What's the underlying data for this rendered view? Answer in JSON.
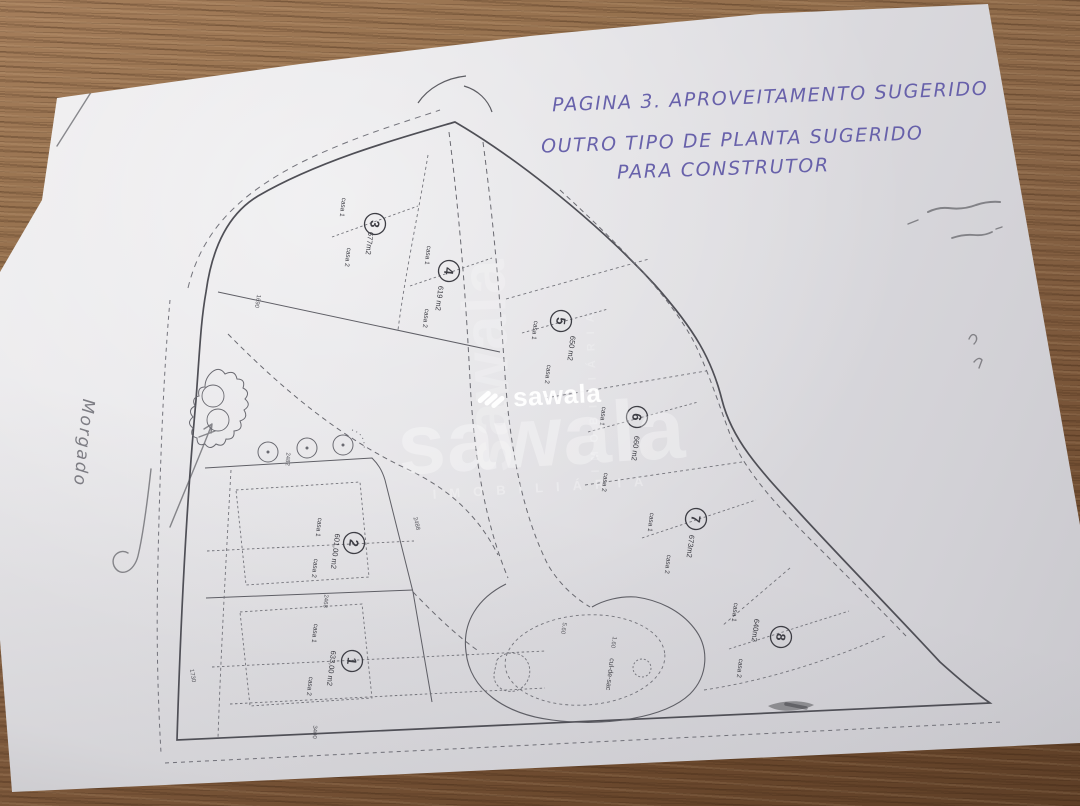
{
  "annotations": {
    "line1": "PAGINA 3. APROVEITAMENTO SUGERIDO",
    "line2": "OUTRO TIPO DE PLANTA SUGERIDO",
    "line3": "PARA CONSTRUTOR",
    "side_note": "Morgado",
    "ink_color": "#5e57a6",
    "pencil_color": "#6e6e73"
  },
  "watermark": {
    "brand": "sawala",
    "subtitle": "IMOBILIÁRIA",
    "color": "#ffffff"
  },
  "plan": {
    "cul_de_sac_label": "cul-de-sac",
    "lots": [
      {
        "number": "1",
        "area": "633,00 m2",
        "house1": "casa 1",
        "house2": "casa 2"
      },
      {
        "number": "2",
        "area": "601,00 m2",
        "house1": "casa 1",
        "house2": "casa 2"
      },
      {
        "number": "3",
        "area": "677m2",
        "house1": "casa 1",
        "house2": "casa 2"
      },
      {
        "number": "4",
        "area": "619 m2",
        "house1": "casa 1",
        "house2": "casa 2"
      },
      {
        "number": "5",
        "area": "650 m2",
        "house1": "casa 1",
        "house2": "casa 2"
      },
      {
        "number": "6",
        "area": "660 m2",
        "house1": "casa 1",
        "house2": "casa 2"
      },
      {
        "number": "7",
        "area": "673m2",
        "house1": "casa 1",
        "house2": "casa 2"
      },
      {
        "number": "8",
        "area": "640m2",
        "house1": "casa 1",
        "house2": "casa 2"
      }
    ],
    "dimensions": [
      "1690",
      "2482",
      "2488",
      "2468",
      "3400",
      "1730",
      "5.60",
      "1.60"
    ]
  }
}
